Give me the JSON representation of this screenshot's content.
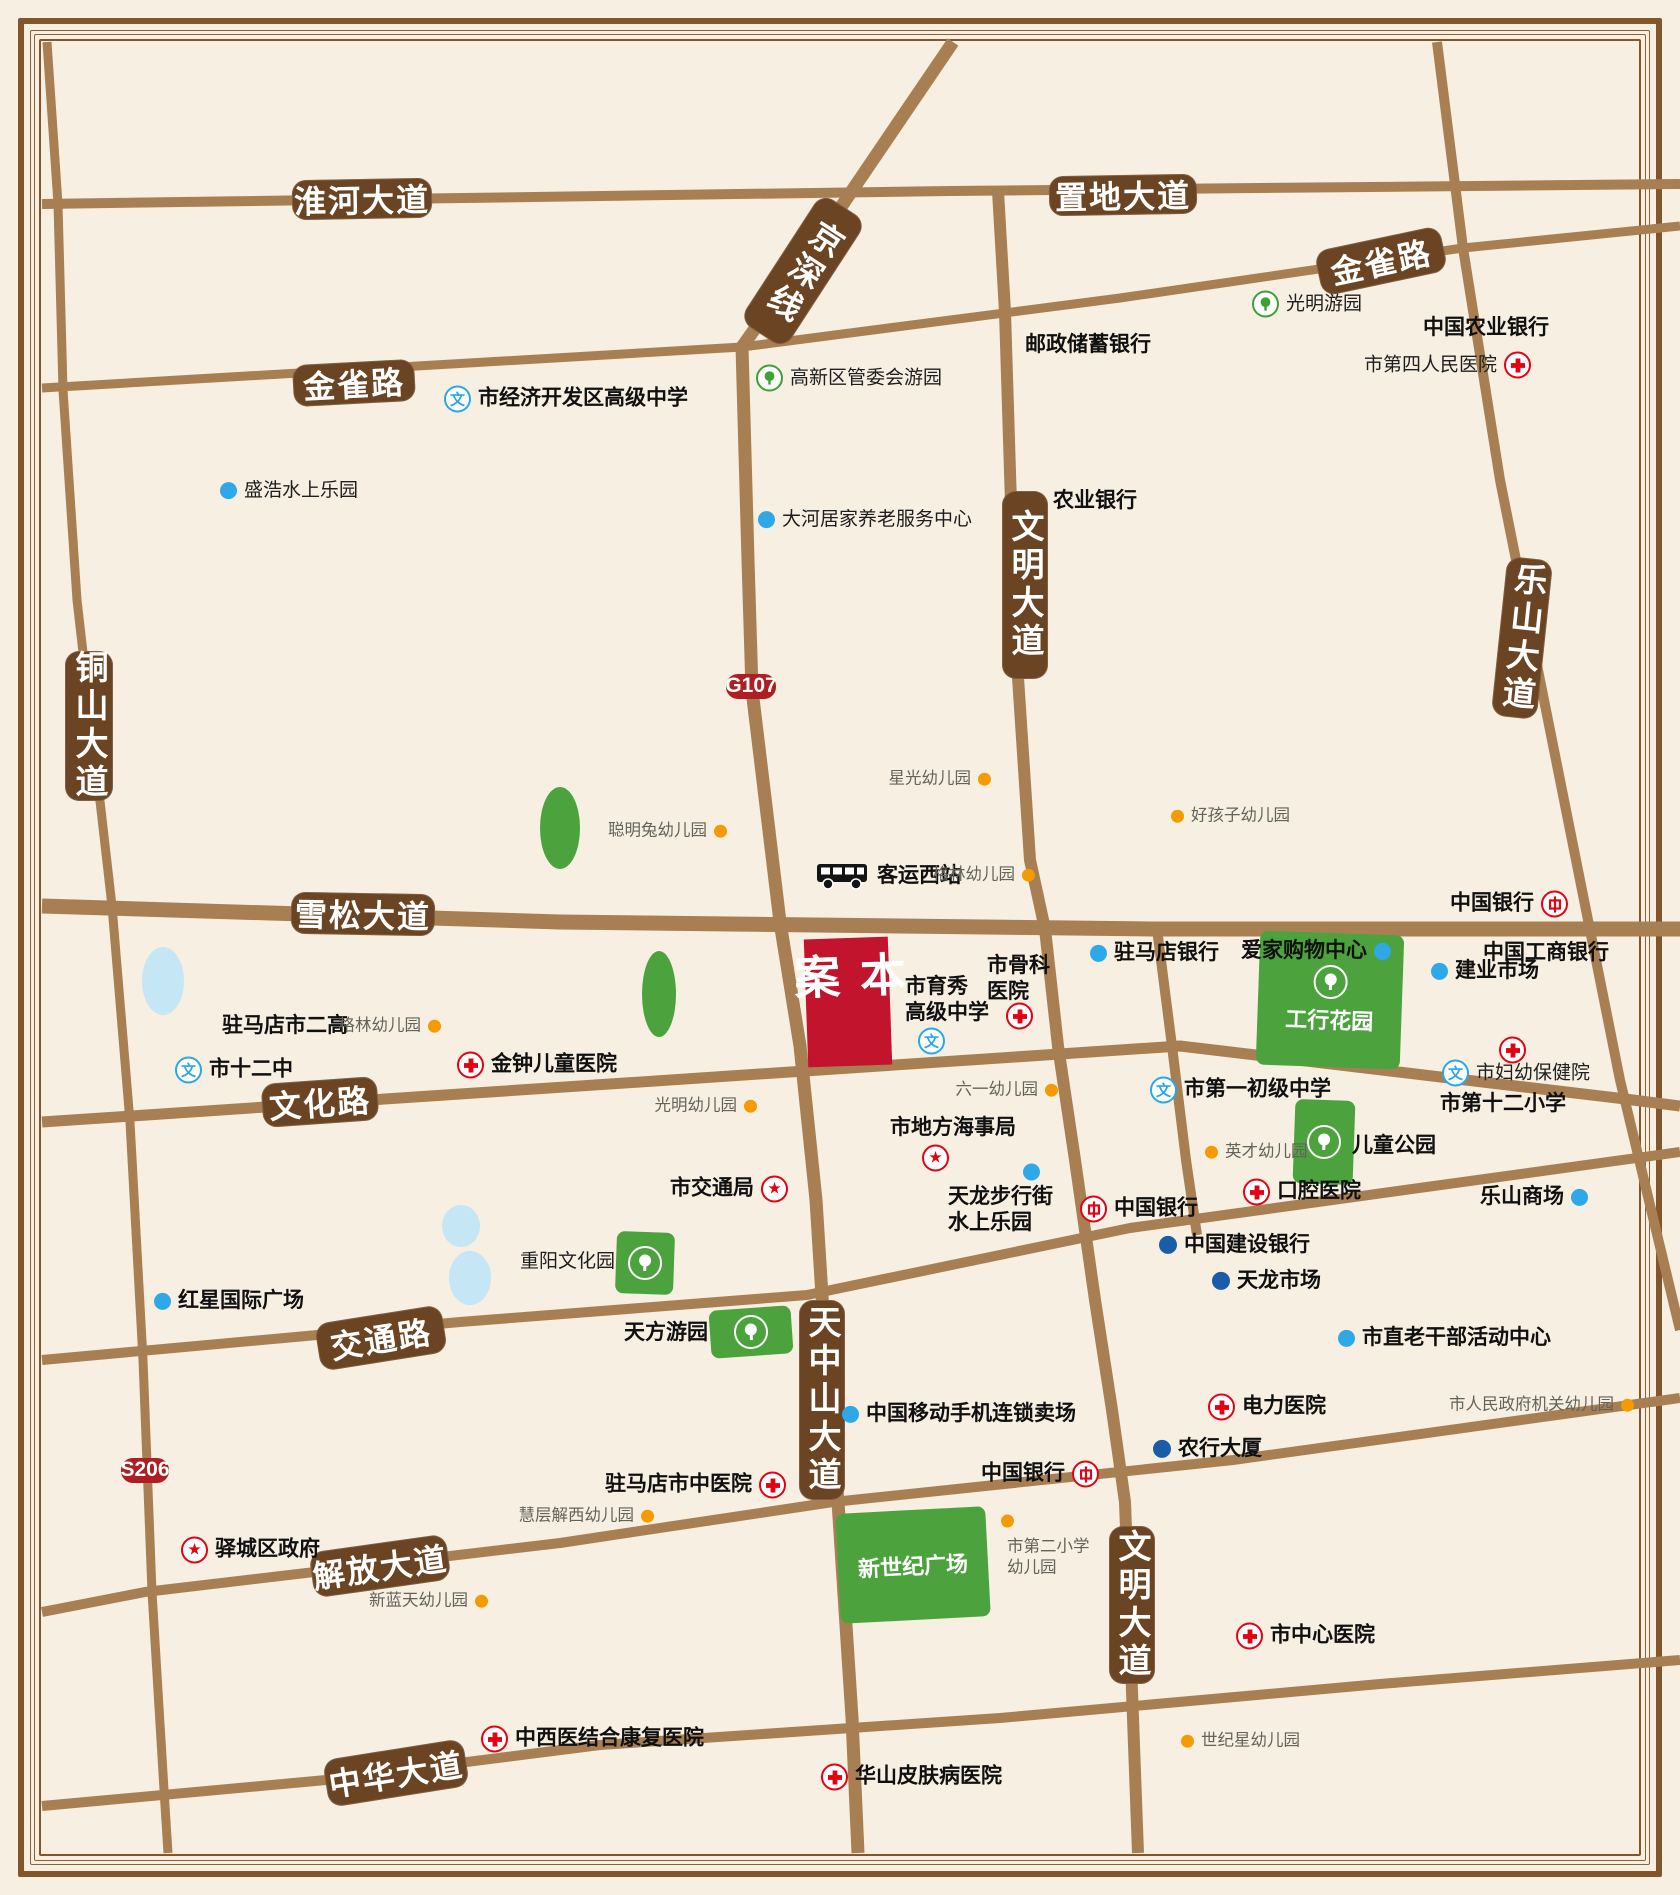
{
  "map": {
    "colors": {
      "bg": "#F6EFE2",
      "road": "#A87F53",
      "pill": "#6A4423",
      "badge": "#B01E23",
      "site": "#C3142D",
      "park": "#4CA33E",
      "water": "#C5E6F4",
      "red": "#E60012",
      "schoolblue": "#2AA7E8",
      "dotblue": "#2FA8E8",
      "dotdark": "#1B5CA8",
      "dotorange": "#F59A00"
    },
    "icon_glyphs": {
      "school": "文",
      "star": "★"
    },
    "roads": [
      {
        "name": "淮河大道-置地大道",
        "w": 10,
        "pts": [
          [
            42,
            204
          ],
          [
            950,
            191
          ],
          [
            1680,
            184
          ]
        ]
      },
      {
        "name": "金雀路",
        "w": 9,
        "pts": [
          [
            42,
            388
          ],
          [
            742,
            347
          ],
          [
            1120,
            298
          ],
          [
            1463,
            248
          ],
          [
            1680,
            226
          ]
        ]
      },
      {
        "name": "雪松大道",
        "w": 15,
        "pts": [
          [
            42,
            906
          ],
          [
            560,
            922
          ],
          [
            1150,
            929
          ],
          [
            1680,
            929
          ]
        ]
      },
      {
        "name": "文化路",
        "w": 11,
        "pts": [
          [
            42,
            1122
          ],
          [
            430,
            1096
          ],
          [
            880,
            1066
          ],
          [
            1180,
            1046
          ],
          [
            1617,
            1098
          ],
          [
            1680,
            1106
          ]
        ]
      },
      {
        "name": "交通路",
        "w": 10,
        "pts": [
          [
            42,
            1360
          ],
          [
            460,
            1322
          ],
          [
            807,
            1295
          ],
          [
            1130,
            1228
          ],
          [
            1680,
            1152
          ]
        ]
      },
      {
        "name": "解放大道",
        "w": 10,
        "pts": [
          [
            42,
            1612
          ],
          [
            145,
            1592
          ],
          [
            560,
            1543
          ],
          [
            833,
            1502
          ],
          [
            1233,
            1460
          ],
          [
            1680,
            1398
          ]
        ]
      },
      {
        "name": "中华大道",
        "w": 10,
        "pts": [
          [
            42,
            1806
          ],
          [
            326,
            1780
          ],
          [
            600,
            1745
          ],
          [
            1000,
            1718
          ],
          [
            1380,
            1684
          ],
          [
            1680,
            1660
          ]
        ]
      },
      {
        "name": "铜山大道-S206",
        "w": 9,
        "pts": [
          [
            47,
            42
          ],
          [
            58,
            204
          ],
          [
            63,
            390
          ],
          [
            77,
            600
          ],
          [
            112,
            906
          ],
          [
            130,
            1122
          ],
          [
            143,
            1360
          ],
          [
            152,
            1592
          ],
          [
            165,
            1806
          ],
          [
            168,
            1853
          ]
        ]
      },
      {
        "name": "京深线-天中山大道",
        "w": 13,
        "pts": [
          [
            953,
            42
          ],
          [
            843,
            204
          ],
          [
            742,
            347
          ],
          [
            748,
            560
          ],
          [
            752,
            690
          ],
          [
            780,
            922
          ],
          [
            800,
            1046
          ],
          [
            816,
            1200
          ],
          [
            826,
            1360
          ],
          [
            838,
            1502
          ],
          [
            852,
            1718
          ],
          [
            858,
            1853
          ]
        ]
      },
      {
        "name": "文明大道",
        "w": 12,
        "pts": [
          [
            998,
            191
          ],
          [
            1005,
            312
          ],
          [
            1015,
            632
          ],
          [
            1030,
            860
          ],
          [
            1045,
            929
          ],
          [
            1058,
            1046
          ],
          [
            1075,
            1160
          ],
          [
            1095,
            1300
          ],
          [
            1112,
            1410
          ],
          [
            1125,
            1502
          ],
          [
            1133,
            1718
          ],
          [
            1138,
            1853
          ]
        ]
      },
      {
        "name": "支路",
        "w": 10,
        "pts": [
          [
            1157,
            929
          ],
          [
            1172,
            1046
          ],
          [
            1186,
            1160
          ],
          [
            1197,
            1235
          ]
        ]
      },
      {
        "name": "乐山大道",
        "w": 10,
        "pts": [
          [
            1437,
            42
          ],
          [
            1463,
            248
          ],
          [
            1500,
            480
          ],
          [
            1585,
            905
          ],
          [
            1620,
            1080
          ],
          [
            1680,
            1330
          ]
        ]
      }
    ],
    "road_labels": [
      {
        "l": "淮河大道",
        "x": 362,
        "y": 199,
        "w": 140,
        "h": 40,
        "rot": -1,
        "vert": false
      },
      {
        "l": "置地大道",
        "x": 1123,
        "y": 195,
        "w": 148,
        "h": 40,
        "rot": -1,
        "vert": false
      },
      {
        "l": "金雀路",
        "x": 354,
        "y": 383,
        "w": 122,
        "h": 42,
        "rot": -3,
        "vert": false
      },
      {
        "l": "金雀路",
        "x": 1381,
        "y": 261,
        "w": 128,
        "h": 46,
        "rot": -12,
        "vert": false
      },
      {
        "l": "京深线",
        "x": 803,
        "y": 271,
        "w": 54,
        "h": 152,
        "rot": 33,
        "vert": true
      },
      {
        "l": "铜山大道",
        "x": 89,
        "y": 726,
        "w": 48,
        "h": 150,
        "rot": 0,
        "vert": true
      },
      {
        "l": "文明大道",
        "x": 1025,
        "y": 585,
        "w": 46,
        "h": 188,
        "rot": 0,
        "vert": true
      },
      {
        "l": "乐山大道",
        "x": 1522,
        "y": 638,
        "w": 46,
        "h": 160,
        "rot": 6,
        "vert": true
      },
      {
        "l": "雪松大道",
        "x": 363,
        "y": 914,
        "w": 144,
        "h": 42,
        "rot": 1,
        "vert": false
      },
      {
        "l": "文化路",
        "x": 320,
        "y": 1102,
        "w": 116,
        "h": 44,
        "rot": -4,
        "vert": false
      },
      {
        "l": "交通路",
        "x": 381,
        "y": 1338,
        "w": 128,
        "h": 48,
        "rot": -9,
        "vert": false
      },
      {
        "l": "天中山大道",
        "x": 822,
        "y": 1400,
        "w": 46,
        "h": 200,
        "rot": 0,
        "vert": true
      },
      {
        "l": "解放大道",
        "x": 380,
        "y": 1566,
        "w": 138,
        "h": 46,
        "rot": -8,
        "vert": false
      },
      {
        "l": "文明大道",
        "x": 1132,
        "y": 1605,
        "w": 46,
        "h": 158,
        "rot": 0,
        "vert": true
      },
      {
        "l": "中华大道",
        "x": 396,
        "y": 1773,
        "w": 142,
        "h": 48,
        "rot": -9,
        "vert": false
      }
    ],
    "route_badges": [
      {
        "l": "G107",
        "x": 751,
        "y": 686,
        "w": 50,
        "h": 25
      },
      {
        "l": "S206",
        "x": 145,
        "y": 1470,
        "w": 48,
        "h": 25
      }
    ],
    "site": {
      "l": "本案",
      "x": 806,
      "y": 938,
      "w": 84,
      "h": 128,
      "rot": -2
    },
    "parks": [
      {
        "l": "工行花园",
        "x": 1258,
        "y": 933,
        "w": 144,
        "h": 134,
        "rot": 2,
        "tree": true,
        "inside": true
      },
      {
        "l": "",
        "x": 1294,
        "y": 1100,
        "w": 60,
        "h": 84,
        "rot": 2,
        "tree": true,
        "inside": false
      },
      {
        "l": "",
        "x": 616,
        "y": 1232,
        "w": 58,
        "h": 62,
        "rot": 2,
        "tree": true,
        "inside": false
      },
      {
        "l": "",
        "x": 710,
        "y": 1308,
        "w": 82,
        "h": 48,
        "rot": -4,
        "tree": true,
        "inside": false
      },
      {
        "l": "新世纪广场",
        "x": 838,
        "y": 1510,
        "w": 150,
        "h": 110,
        "rot": -3,
        "tree": false,
        "inside": true
      }
    ],
    "green_spots": [
      [
        560,
        828,
        40,
        82
      ],
      [
        659,
        994,
        34,
        86
      ]
    ],
    "ponds": [
      [
        163,
        981,
        42,
        68
      ],
      [
        461,
        1226,
        38,
        42
      ],
      [
        470,
        1278,
        42,
        54
      ]
    ],
    "pois": [
      {
        "t": "school",
        "x": 458,
        "y": 399,
        "l": "市经济开发区高级中学",
        "s": "r",
        "st": "b"
      },
      {
        "t": "tree",
        "x": 770,
        "y": 378,
        "l": "高新区管委会游园",
        "s": "r",
        "st": "r"
      },
      {
        "t": "dotb",
        "x": 234,
        "y": 491,
        "l": "盛浩水上乐园",
        "s": "r",
        "st": "r"
      },
      {
        "t": "none",
        "x": 1025,
        "y": 345,
        "l": "邮政储蓄银行",
        "s": "r",
        "st": "b"
      },
      {
        "t": "tree",
        "x": 1266,
        "y": 304,
        "l": "光明游园",
        "s": "r",
        "st": "r"
      },
      {
        "t": "none",
        "x": 1423,
        "y": 328,
        "l": "中国农业银行",
        "s": "r",
        "st": "b"
      },
      {
        "t": "hospital",
        "x": 1517,
        "y": 365,
        "l": "市第四人民医院",
        "s": "l",
        "st": "r"
      },
      {
        "t": "dotb",
        "x": 772,
        "y": 520,
        "l": "大河居家养老服务中心",
        "s": "r",
        "st": "r"
      },
      {
        "t": "none",
        "x": 1053,
        "y": 501,
        "l": "农业银行",
        "s": "r",
        "st": "b"
      },
      {
        "t": "doto",
        "x": 977,
        "y": 779,
        "l": "星光幼儿园",
        "s": "l",
        "st": "s"
      },
      {
        "t": "doto",
        "x": 713,
        "y": 831,
        "l": "聪明兔幼儿园",
        "s": "l",
        "st": "s"
      },
      {
        "t": "doto",
        "x": 1185,
        "y": 816,
        "l": "好孩子幼儿园",
        "s": "r",
        "st": "s"
      },
      {
        "t": "bus",
        "x": 830,
        "y": 876,
        "l": "客运西站",
        "s": "r",
        "st": "b"
      },
      {
        "t": "doto",
        "x": 1021,
        "y": 875,
        "l": "格林幼儿园",
        "s": "l",
        "st": "s"
      },
      {
        "t": "boc",
        "x": 1554,
        "y": 904,
        "l": "中国银行",
        "s": "l",
        "st": "b"
      },
      {
        "t": "dotb",
        "x": 1104,
        "y": 953,
        "l": "驻马店银行",
        "s": "r",
        "st": "b"
      },
      {
        "t": "dotb",
        "x": 1377,
        "y": 951,
        "l": "爱家购物中心",
        "s": "l",
        "st": "b"
      },
      {
        "t": "none",
        "x": 1483,
        "y": 953,
        "l": "中国工商银行",
        "s": "r",
        "st": "b"
      },
      {
        "t": "dotb",
        "x": 1445,
        "y": 971,
        "l": "建业市场",
        "s": "r",
        "st": "b"
      },
      {
        "t": "none",
        "x": 905,
        "y": 1000,
        "lines": [
          "市育秀",
          "高级中学"
        ],
        "s": "r",
        "st": "b"
      },
      {
        "t": "school",
        "x": 932,
        "y": 1041,
        "l": ""
      },
      {
        "t": "none",
        "x": 987,
        "y": 979,
        "lines": [
          "市骨科",
          "医院"
        ],
        "s": "r",
        "st": "b"
      },
      {
        "t": "hospital",
        "x": 1020,
        "y": 1016,
        "l": ""
      },
      {
        "t": "none",
        "x": 222,
        "y": 1026,
        "l": "驻马店市二高",
        "s": "r",
        "st": "b"
      },
      {
        "t": "doto",
        "x": 427,
        "y": 1026,
        "l": "格林幼儿园",
        "s": "l",
        "st": "s"
      },
      {
        "t": "school",
        "x": 189,
        "y": 1070,
        "l": "市十二中",
        "s": "r",
        "st": "b"
      },
      {
        "t": "hospital",
        "x": 471,
        "y": 1065,
        "l": "金钟儿童医院",
        "s": "r",
        "st": "b"
      },
      {
        "t": "doto",
        "x": 743,
        "y": 1106,
        "l": "光明幼儿园",
        "s": "l",
        "st": "s"
      },
      {
        "t": "doto",
        "x": 1044,
        "y": 1090,
        "l": "六一幼儿园",
        "s": "l",
        "st": "s"
      },
      {
        "t": "school",
        "x": 1164,
        "y": 1090,
        "l": "市第一初级中学",
        "s": "r",
        "st": "b"
      },
      {
        "t": "hospital",
        "x": 1513,
        "y": 1050,
        "l": ""
      },
      {
        "t": "school",
        "x": 1456,
        "y": 1073,
        "l": "市妇幼保健院",
        "s": "r",
        "st": "r"
      },
      {
        "t": "none",
        "x": 1440,
        "y": 1104,
        "l": "市第十二小学",
        "s": "r",
        "st": "b"
      },
      {
        "t": "doto",
        "x": 1219,
        "y": 1152,
        "l": "英才幼儿园",
        "s": "r",
        "st": "s"
      },
      {
        "t": "none",
        "x": 1352,
        "y": 1146,
        "l": "儿童公园",
        "s": "r",
        "st": "b"
      },
      {
        "t": "hospital",
        "x": 1257,
        "y": 1192,
        "l": "口腔医院",
        "s": "r",
        "st": "b"
      },
      {
        "t": "boc",
        "x": 1094,
        "y": 1209,
        "l": "中国银行",
        "s": "r",
        "st": "b"
      },
      {
        "t": "dotb",
        "x": 1574,
        "y": 1197,
        "l": "乐山商场",
        "s": "l",
        "st": "b"
      },
      {
        "t": "none",
        "x": 890,
        "y": 1128,
        "l": "市地方海事局",
        "s": "r",
        "st": "b"
      },
      {
        "t": "star",
        "x": 936,
        "y": 1158,
        "l": ""
      },
      {
        "t": "star",
        "x": 774,
        "y": 1189,
        "l": "市交通局",
        "s": "l",
        "st": "b"
      },
      {
        "t": "dotb",
        "x": 1037,
        "y": 1172,
        "l": ""
      },
      {
        "t": "none",
        "x": 948,
        "y": 1210,
        "lines": [
          "天龙步行街",
          "水上乐园"
        ],
        "s": "r",
        "st": "b"
      },
      {
        "t": "dotd",
        "x": 1173,
        "y": 1245,
        "l": "中国建设银行",
        "s": "r",
        "st": "b"
      },
      {
        "t": "dotd",
        "x": 1226,
        "y": 1281,
        "l": "天龙市场",
        "s": "r",
        "st": "b"
      },
      {
        "t": "dotb",
        "x": 1352,
        "y": 1338,
        "l": "市直老干部活动中心",
        "s": "r",
        "st": "b"
      },
      {
        "t": "none",
        "x": 615,
        "y": 1262,
        "l": "重阳文化园",
        "s": "l",
        "st": "r"
      },
      {
        "t": "dotb",
        "x": 168,
        "y": 1301,
        "l": "红星国际广场",
        "s": "r",
        "st": "b"
      },
      {
        "t": "none",
        "x": 708,
        "y": 1333,
        "l": "天方游园",
        "s": "l",
        "st": "b"
      },
      {
        "t": "star",
        "x": 195,
        "y": 1550,
        "l": "驿城区政府",
        "s": "r",
        "st": "b"
      },
      {
        "t": "doto",
        "x": 640,
        "y": 1516,
        "l": "慧层解西幼儿园",
        "s": "l",
        "st": "s"
      },
      {
        "t": "dotb",
        "x": 856,
        "y": 1414,
        "l": "中国移动手机连锁卖场",
        "s": "r",
        "st": "b"
      },
      {
        "t": "boc",
        "x": 1085,
        "y": 1474,
        "l": "中国银行",
        "s": "l",
        "st": "b"
      },
      {
        "t": "hospital",
        "x": 772,
        "y": 1485,
        "l": "驻马店市中医院",
        "s": "l",
        "st": "b"
      },
      {
        "t": "doto",
        "x": 1015,
        "y": 1521,
        "l": ""
      },
      {
        "t": "none",
        "x": 1007,
        "y": 1557,
        "lines": [
          "市第二小学",
          "幼儿园"
        ],
        "s": "r",
        "st": "s"
      },
      {
        "t": "hospital",
        "x": 1222,
        "y": 1407,
        "l": "电力医院",
        "s": "r",
        "st": "b"
      },
      {
        "t": "dotd",
        "x": 1167,
        "y": 1449,
        "l": "农行大厦",
        "s": "r",
        "st": "b"
      },
      {
        "t": "doto",
        "x": 1620,
        "y": 1405,
        "l": "市人民政府机关幼儿园",
        "s": "l",
        "st": "s"
      },
      {
        "t": "hospital",
        "x": 1250,
        "y": 1636,
        "l": "市中心医院",
        "s": "r",
        "st": "b"
      },
      {
        "t": "doto",
        "x": 474,
        "y": 1601,
        "l": "新蓝天幼儿园",
        "s": "l",
        "st": "s"
      },
      {
        "t": "hospital",
        "x": 495,
        "y": 1739,
        "l": "中西医结合康复医院",
        "s": "r",
        "st": "b"
      },
      {
        "t": "doto",
        "x": 1195,
        "y": 1741,
        "l": "世纪星幼儿园",
        "s": "r",
        "st": "s"
      },
      {
        "t": "hospital",
        "x": 835,
        "y": 1777,
        "l": "华山皮肤病医院",
        "s": "r",
        "st": "b"
      }
    ]
  }
}
